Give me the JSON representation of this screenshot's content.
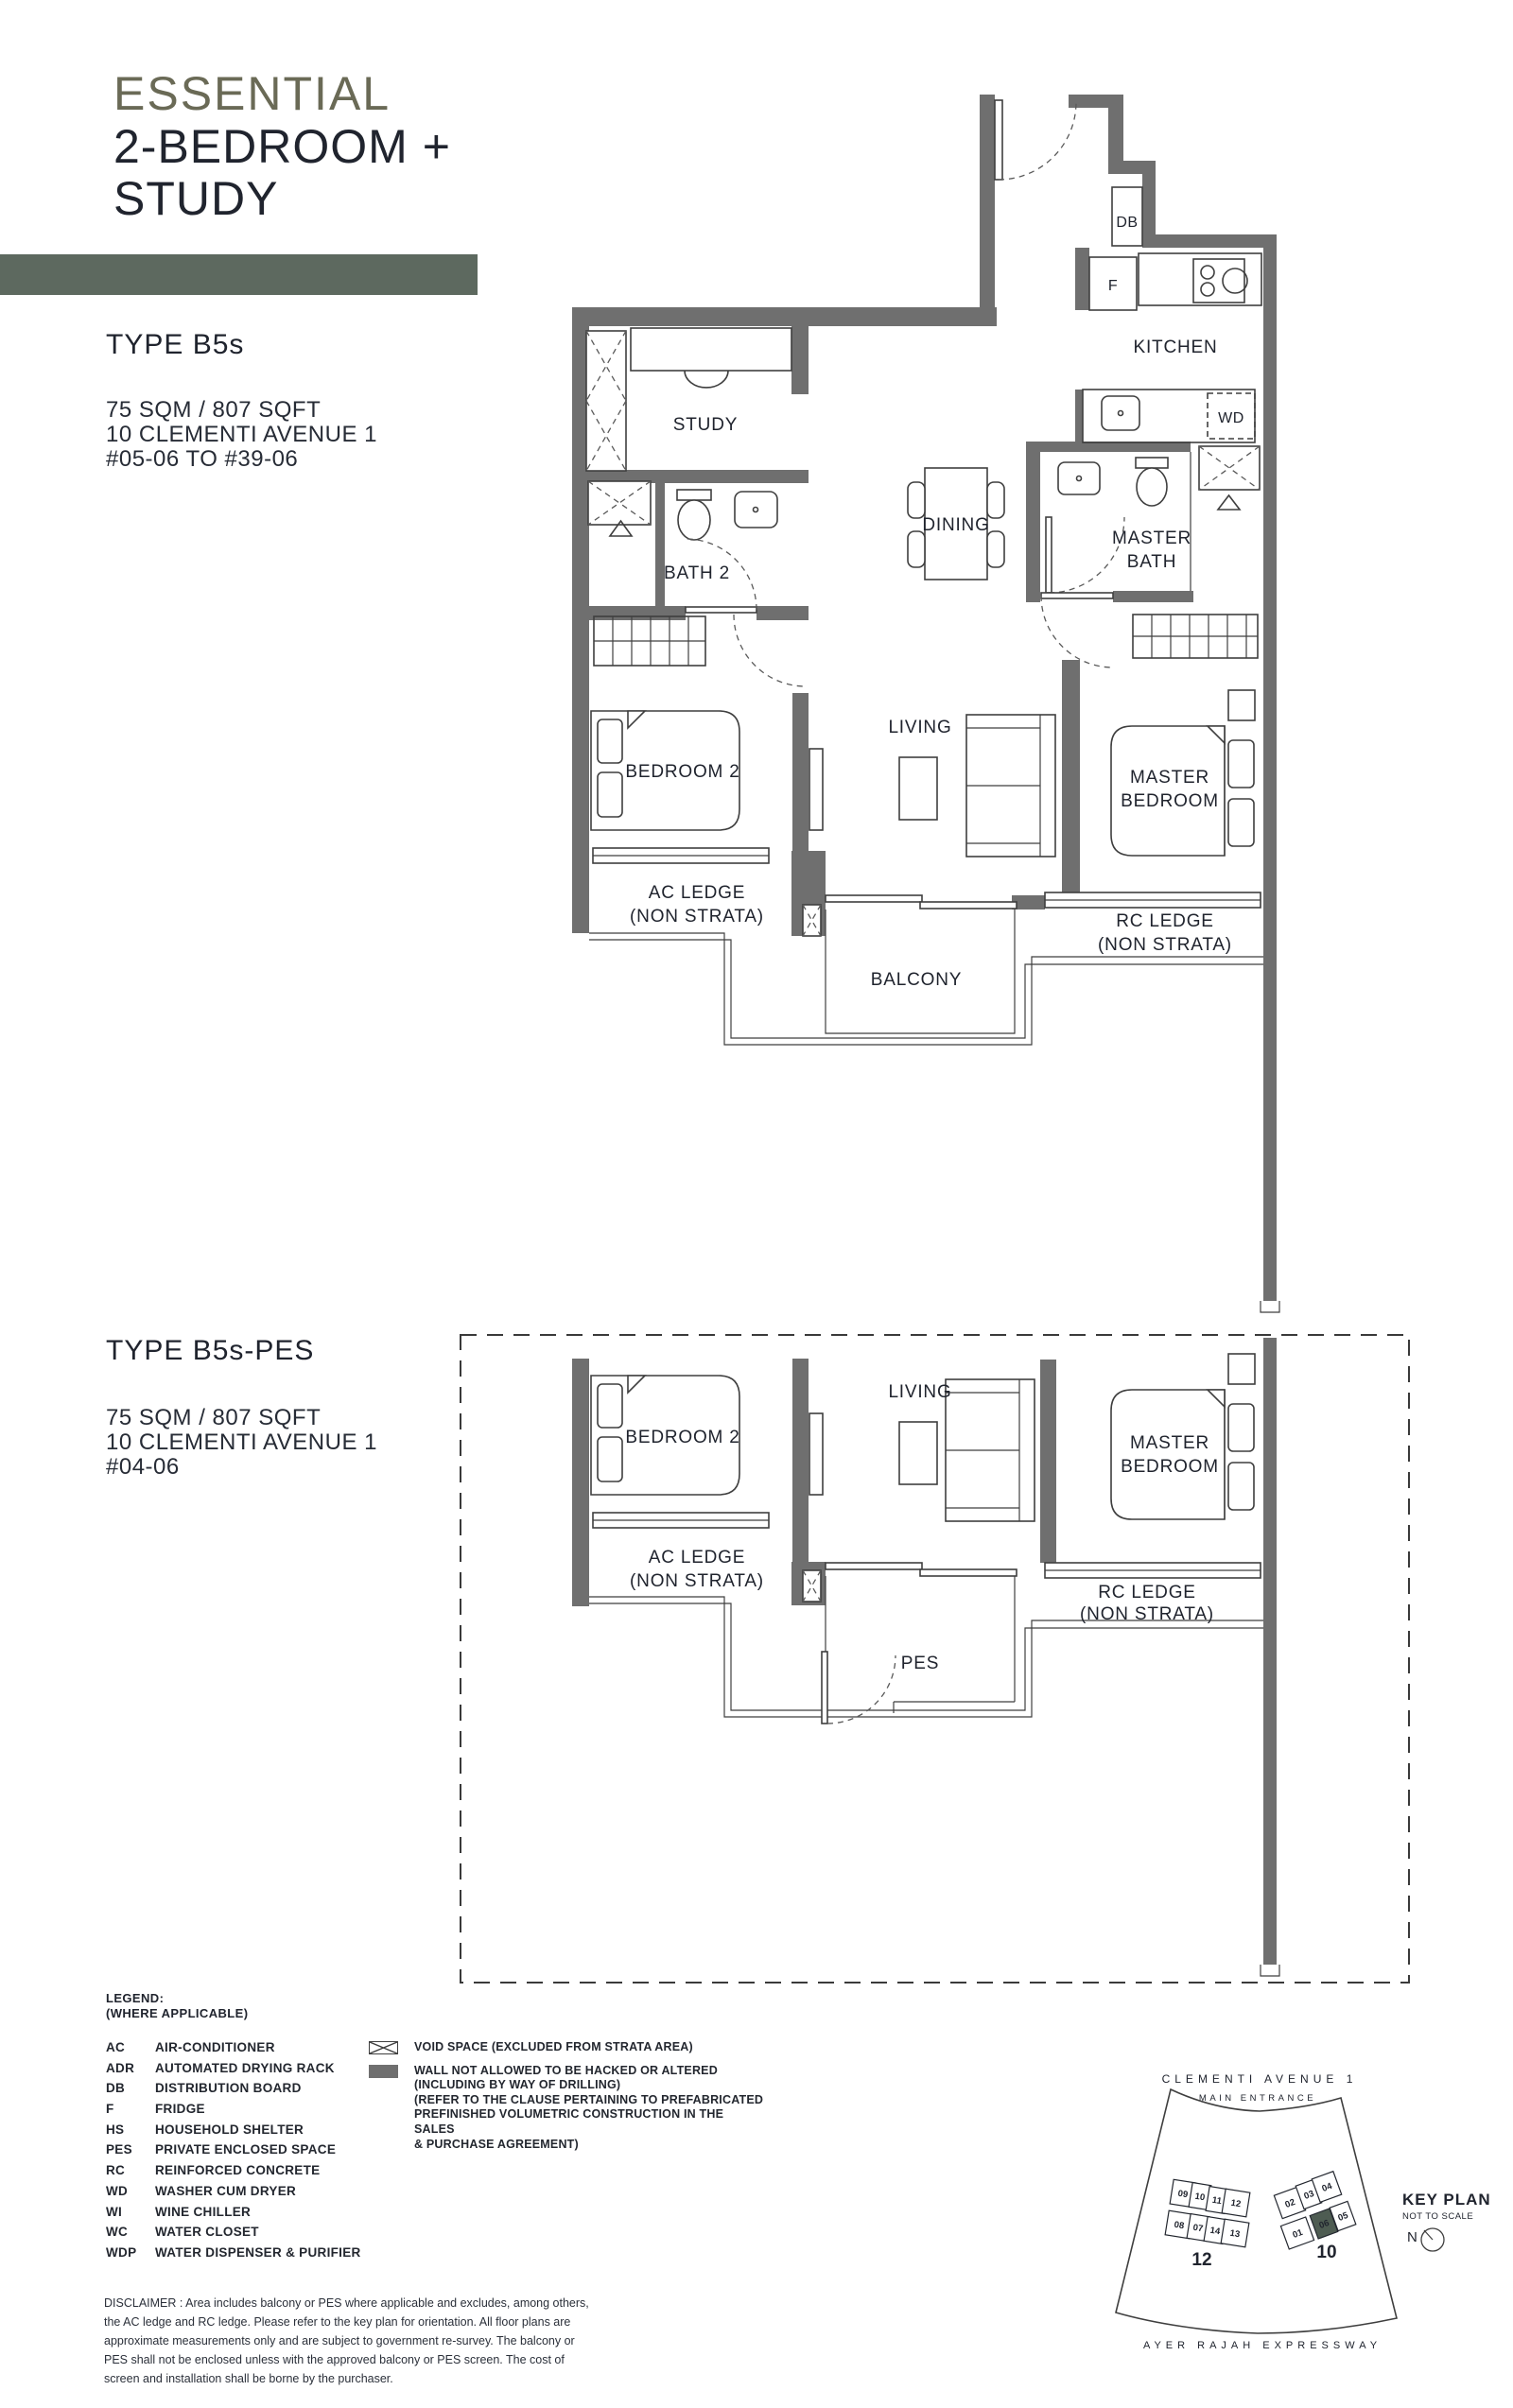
{
  "header": {
    "brand": "ESSENTIAL",
    "title_line1": "2-BEDROOM +",
    "title_line2": "STUDY"
  },
  "type1": {
    "title": "TYPE B5s",
    "area": "75 SQM / 807 SQFT",
    "address": "10 CLEMENTI AVENUE 1",
    "units": "#05-06 TO #39-06"
  },
  "type2": {
    "title": "TYPE B5s-PES",
    "area": "75 SQM / 807 SQFT",
    "address": "10 CLEMENTI AVENUE 1",
    "units": "#04-06"
  },
  "plan1_labels": {
    "db": "DB",
    "fridge": "F",
    "kitchen": "KITCHEN",
    "wd": "WD",
    "study": "STUDY",
    "bath2": "BATH 2",
    "dining": "DINING",
    "master_bath_1": "MASTER",
    "master_bath_2": "BATH",
    "living": "LIVING",
    "bedroom2": "BEDROOM 2",
    "master_bedroom_1": "MASTER",
    "master_bedroom_2": "BEDROOM",
    "ac_ledge_1": "AC LEDGE",
    "ac_ledge_2": "(NON STRATA)",
    "rc_ledge_1": "RC LEDGE",
    "rc_ledge_2": "(NON STRATA)",
    "balcony": "BALCONY"
  },
  "plan2_labels": {
    "bedroom2": "BEDROOM 2",
    "living": "LIVING",
    "master_bedroom_1": "MASTER",
    "master_bedroom_2": "BEDROOM",
    "ac_ledge_1": "AC LEDGE",
    "ac_ledge_2": "(NON STRATA)",
    "rc_ledge_1": "RC LEDGE",
    "rc_ledge_2": "(NON STRATA)",
    "pes": "PES"
  },
  "legend": {
    "title": "LEGEND:",
    "subtitle": "(WHERE APPLICABLE)",
    "items": [
      {
        "abbr": "AC",
        "label": "AIR-CONDITIONER"
      },
      {
        "abbr": "ADR",
        "label": "AUTOMATED DRYING RACK"
      },
      {
        "abbr": "DB",
        "label": "DISTRIBUTION BOARD"
      },
      {
        "abbr": "F",
        "label": "FRIDGE"
      },
      {
        "abbr": "HS",
        "label": "HOUSEHOLD SHELTER"
      },
      {
        "abbr": "PES",
        "label": "PRIVATE ENCLOSED SPACE"
      },
      {
        "abbr": "RC",
        "label": "REINFORCED CONCRETE"
      },
      {
        "abbr": "WD",
        "label": "WASHER CUM DRYER"
      },
      {
        "abbr": "WI",
        "label": "WINE CHILLER"
      },
      {
        "abbr": "WC",
        "label": "WATER CLOSET"
      },
      {
        "abbr": "WDP",
        "label": "WATER DISPENSER & PURIFIER"
      }
    ],
    "void_symbol_label": "VOID SPACE (EXCLUDED FROM STRATA AREA)",
    "wall_symbol_line1": "WALL NOT ALLOWED TO BE HACKED OR ALTERED",
    "wall_symbol_line2": "(INCLUDING BY WAY OF DRILLING)",
    "wall_symbol_line3": "(REFER TO THE CLAUSE PERTAINING TO PREFABRICATED",
    "wall_symbol_line4": "PREFINISHED VOLUMETRIC CONSTRUCTION IN THE SALES",
    "wall_symbol_line5": "& PURCHASE AGREEMENT)"
  },
  "keyplan": {
    "road_top": "CLEMENTI  AVENUE 1",
    "entrance": "MAIN  ENTRANCE",
    "title": "KEY PLAN",
    "scale_note": "NOT TO SCALE",
    "north": "N",
    "road_bottom": "AYER  RAJAH  EXPRESSWAY",
    "tower_left": "12",
    "tower_right": "10",
    "left_units_top": [
      "09",
      "10",
      "11",
      "12"
    ],
    "left_units_bottom": [
      "08",
      "07",
      "14",
      "13"
    ],
    "right_units_top": [
      "02",
      "03",
      "04"
    ],
    "right_units_bottom": [
      "01",
      "06",
      "05"
    ],
    "highlighted_unit": "06"
  },
  "disclaimer": "DISCLAIMER : Area includes balcony or PES where applicable and excludes, among others, the AC ledge and RC ledge. Please refer to the key plan for orientation. All floor plans are approximate measurements only and are subject to government re-survey. The balcony or PES shall not be enclosed unless with the approved balcony or PES screen. The cost of screen and installation shall be borne by the purchaser.",
  "colors": {
    "accent_text": "#6a6a56",
    "accent_bar": "#5d695f",
    "wall_gray": "#6f6f6f",
    "highlight_unit": "#4e5c52"
  }
}
